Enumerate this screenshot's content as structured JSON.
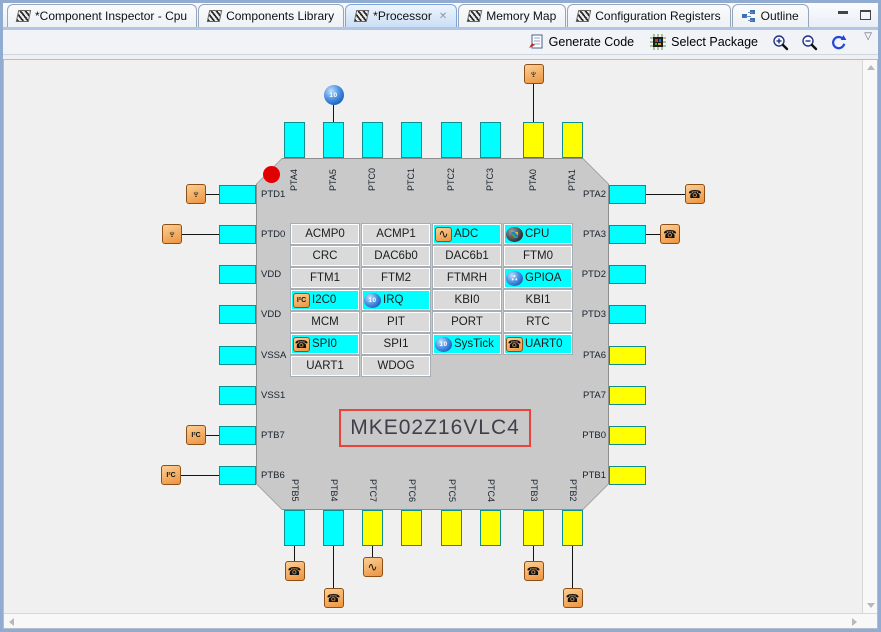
{
  "tabs": [
    {
      "label": "*Component Inspector - Cpu",
      "icon": "component",
      "active": false,
      "closable": false
    },
    {
      "label": "Components Library",
      "icon": "component",
      "active": false,
      "closable": false
    },
    {
      "label": "*Processor",
      "icon": "component",
      "active": true,
      "closable": true
    },
    {
      "label": "Memory Map",
      "icon": "component",
      "active": false,
      "closable": false
    },
    {
      "label": "Configuration Registers",
      "icon": "component",
      "active": false,
      "closable": false
    },
    {
      "label": "Outline",
      "icon": "outline",
      "active": false,
      "closable": false
    }
  ],
  "toolbar": {
    "generate_code_label": "Generate Code",
    "select_package_label": "Select Package"
  },
  "chip": {
    "name": "MKE02Z16VLC4",
    "pins": {
      "top": [
        {
          "label": "PTA4",
          "color": "cyan"
        },
        {
          "label": "PTA5",
          "color": "cyan",
          "icon": "irq",
          "icon_gap": 17
        },
        {
          "label": "PTC0",
          "color": "cyan"
        },
        {
          "label": "PTC1",
          "color": "cyan"
        },
        {
          "label": "PTC2",
          "color": "cyan"
        },
        {
          "label": "PTC3",
          "color": "cyan"
        },
        {
          "label": "PTA0",
          "color": "yellow",
          "icon": "gpio",
          "icon_gap": 38
        },
        {
          "label": "PTA1",
          "color": "yellow"
        }
      ],
      "left": [
        {
          "label": "PTD1",
          "color": "cyan",
          "icon": "gpio",
          "icon_gap": 13
        },
        {
          "label": "PTD0",
          "color": "cyan",
          "icon": "gpio",
          "icon_gap": 37
        },
        {
          "label": "VDD",
          "color": "cyan"
        },
        {
          "label": "VDD",
          "color": "cyan"
        },
        {
          "label": "VSSA",
          "color": "cyan"
        },
        {
          "label": "VSS1",
          "color": "cyan"
        },
        {
          "label": "PTB7",
          "color": "cyan",
          "icon": "i2c",
          "icon_gap": 13
        },
        {
          "label": "PTB6",
          "color": "cyan",
          "icon": "i2c",
          "icon_gap": 38
        }
      ],
      "right": [
        {
          "label": "PTA2",
          "color": "cyan",
          "icon": "uart",
          "icon_gap": 39
        },
        {
          "label": "PTA3",
          "color": "cyan",
          "icon": "uart",
          "icon_gap": 14
        },
        {
          "label": "PTD2",
          "color": "cyan"
        },
        {
          "label": "PTD3",
          "color": "cyan"
        },
        {
          "label": "PTA6",
          "color": "yellow"
        },
        {
          "label": "PTA7",
          "color": "yellow"
        },
        {
          "label": "PTB0",
          "color": "yellow"
        },
        {
          "label": "PTB1",
          "color": "yellow"
        }
      ],
      "bottom": [
        {
          "label": "PTB5",
          "color": "cyan",
          "icon": "uart",
          "icon_gap": 15
        },
        {
          "label": "PTB4",
          "color": "cyan",
          "icon": "uart",
          "icon_gap": 42
        },
        {
          "label": "PTC7",
          "color": "yellow",
          "icon": "adc",
          "icon_gap": 11
        },
        {
          "label": "PTC6",
          "color": "yellow"
        },
        {
          "label": "PTC5",
          "color": "yellow"
        },
        {
          "label": "PTC4",
          "color": "yellow"
        },
        {
          "label": "PTB3",
          "color": "yellow",
          "icon": "uart",
          "icon_gap": 15
        },
        {
          "label": "PTB2",
          "color": "yellow",
          "icon": "uart",
          "icon_gap": 42
        }
      ]
    },
    "peripherals": [
      [
        {
          "label": "ACMP0"
        },
        {
          "label": "ACMP1"
        },
        {
          "label": "ADC",
          "hl": true,
          "icon": "adc"
        },
        {
          "label": "CPU",
          "hl": true,
          "icon": "cpu"
        }
      ],
      [
        {
          "label": "CRC"
        },
        {
          "label": "DAC6b0"
        },
        {
          "label": "DAC6b1"
        },
        {
          "label": "FTM0"
        }
      ],
      [
        {
          "label": "FTM1"
        },
        {
          "label": "FTM2"
        },
        {
          "label": "FTMRH"
        },
        {
          "label": "GPIOA",
          "hl": true,
          "icon": "gpioa"
        }
      ],
      [
        {
          "label": "I2C0",
          "hl": true,
          "icon": "i2c"
        },
        {
          "label": "IRQ",
          "hl": true,
          "icon": "irq"
        },
        {
          "label": "KBI0"
        },
        {
          "label": "KBI1"
        }
      ],
      [
        {
          "label": "MCM"
        },
        {
          "label": "PIT"
        },
        {
          "label": "PORT"
        },
        {
          "label": "RTC"
        }
      ],
      [
        {
          "label": "SPI0",
          "hl": true,
          "icon": "uart"
        },
        {
          "label": "SPI1"
        },
        {
          "label": "SysTick",
          "hl": true,
          "icon": "irq"
        },
        {
          "label": "UART0",
          "hl": true,
          "icon": "uart"
        }
      ],
      [
        {
          "label": "UART1"
        },
        {
          "label": "WDOG"
        }
      ]
    ]
  },
  "icons": {
    "gpio": "♆",
    "uart": "☎",
    "i2c": "I²C",
    "adc": "∿",
    "irq": "10",
    "gpioa": "∴",
    "cpu": "",
    "close": "✕",
    "overflow": "▽"
  },
  "colors": {
    "cyan": "#00FFFF",
    "yellow": "#FFFF00",
    "highlight": "#00FFFF",
    "chip_body": "#C9C9C9",
    "name_border": "#E8443C",
    "pin1_marker": "#E00000"
  }
}
